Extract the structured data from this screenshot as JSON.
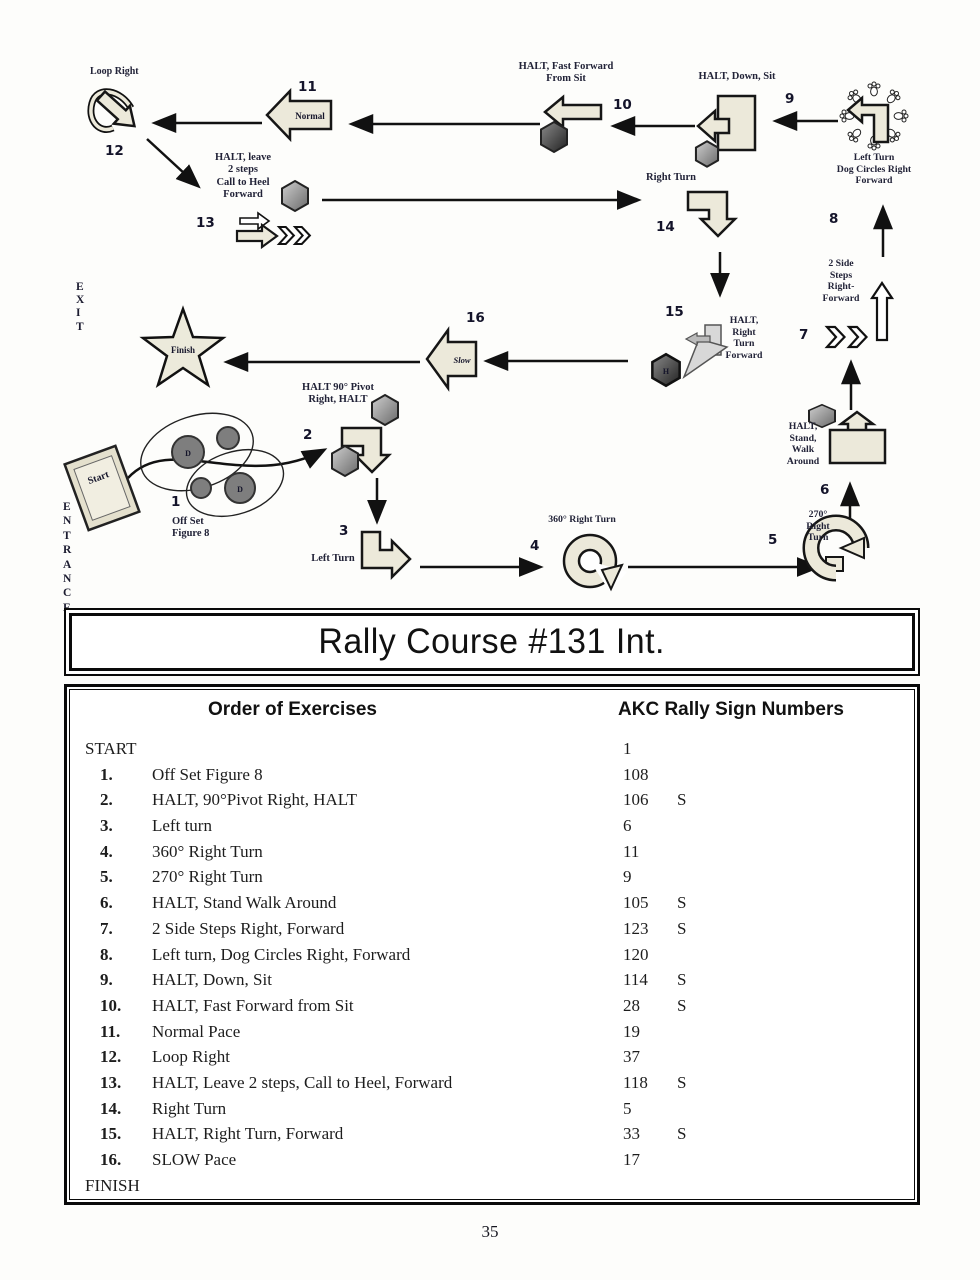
{
  "title": "Rally Course #131 Int.",
  "page_number": "35",
  "course": {
    "entrance": "ENTRANCE",
    "exit": "EXIT",
    "start": "Start",
    "finish": "Finish",
    "bowl_letter": "D",
    "hex15_letter": "H",
    "stations": [
      {
        "num": "1",
        "label": "Off Set\nFigure 8"
      },
      {
        "num": "2",
        "label": "HALT 90° Pivot\nRight, HALT"
      },
      {
        "num": "3",
        "label": "Left Turn"
      },
      {
        "num": "4",
        "label": "360° Right Turn"
      },
      {
        "num": "5",
        "label": "270°\nRight\nTurn"
      },
      {
        "num": "6",
        "label": "HALT,\nStand,\nWalk\nAround"
      },
      {
        "num": "7",
        "label": "2 Side\nSteps\nRight-\nForward"
      },
      {
        "num": "8",
        "label": "Left Turn\nDog Circles Right\nForward"
      },
      {
        "num": "9",
        "label": "HALT, Down, Sit"
      },
      {
        "num": "10",
        "label": "HALT, Fast Forward\nFrom Sit"
      },
      {
        "num": "11",
        "label": "Normal"
      },
      {
        "num": "12",
        "label": "Loop Right"
      },
      {
        "num": "13",
        "label": "HALT, leave\n2 steps\nCall to Heel\nForward"
      },
      {
        "num": "14",
        "label": "Right Turn"
      },
      {
        "num": "15",
        "label": "HALT,\nRight\nTurn\nForward"
      },
      {
        "num": "16",
        "label": "Slow"
      }
    ]
  },
  "table": {
    "col1_header": "Order of Exercises",
    "col2_header": "AKC Rally Sign Numbers",
    "rows": [
      {
        "num": "",
        "exercise": "START",
        "sign": "1",
        "s": ""
      },
      {
        "num": "1.",
        "exercise": "Off Set Figure 8",
        "sign": "108",
        "s": ""
      },
      {
        "num": "2.",
        "exercise": "HALT, 90°Pivot Right, HALT",
        "sign": "106",
        "s": "S"
      },
      {
        "num": "3.",
        "exercise": "Left turn",
        "sign": "6",
        "s": ""
      },
      {
        "num": "4.",
        "exercise": "360° Right Turn",
        "sign": "11",
        "s": ""
      },
      {
        "num": "5.",
        "exercise": "270° Right Turn",
        "sign": "9",
        "s": ""
      },
      {
        "num": "6.",
        "exercise": "HALT, Stand Walk Around",
        "sign": "105",
        "s": "S"
      },
      {
        "num": "7.",
        "exercise": "2 Side Steps Right, Forward",
        "sign": "123",
        "s": "S"
      },
      {
        "num": "8.",
        "exercise": "Left turn, Dog Circles Right, Forward",
        "sign": "120",
        "s": ""
      },
      {
        "num": "9.",
        "exercise": "HALT, Down, Sit",
        "sign": "114",
        "s": "S"
      },
      {
        "num": "10.",
        "exercise": "HALT, Fast Forward from Sit",
        "sign": "28",
        "s": "S"
      },
      {
        "num": "11.",
        "exercise": "Normal Pace",
        "sign": "19",
        "s": ""
      },
      {
        "num": "12.",
        "exercise": "Loop Right",
        "sign": "37",
        "s": ""
      },
      {
        "num": "13.",
        "exercise": "HALT, Leave 2 steps, Call to Heel, Forward",
        "sign": "118",
        "s": "S"
      },
      {
        "num": "14.",
        "exercise": "Right Turn",
        "sign": "5",
        "s": ""
      },
      {
        "num": "15.",
        "exercise": "HALT, Right Turn, Forward",
        "sign": "33",
        "s": "S"
      },
      {
        "num": "16.",
        "exercise": "SLOW Pace",
        "sign": "17",
        "s": ""
      },
      {
        "num": "",
        "exercise": "FINISH",
        "sign": "",
        "s": ""
      }
    ]
  }
}
